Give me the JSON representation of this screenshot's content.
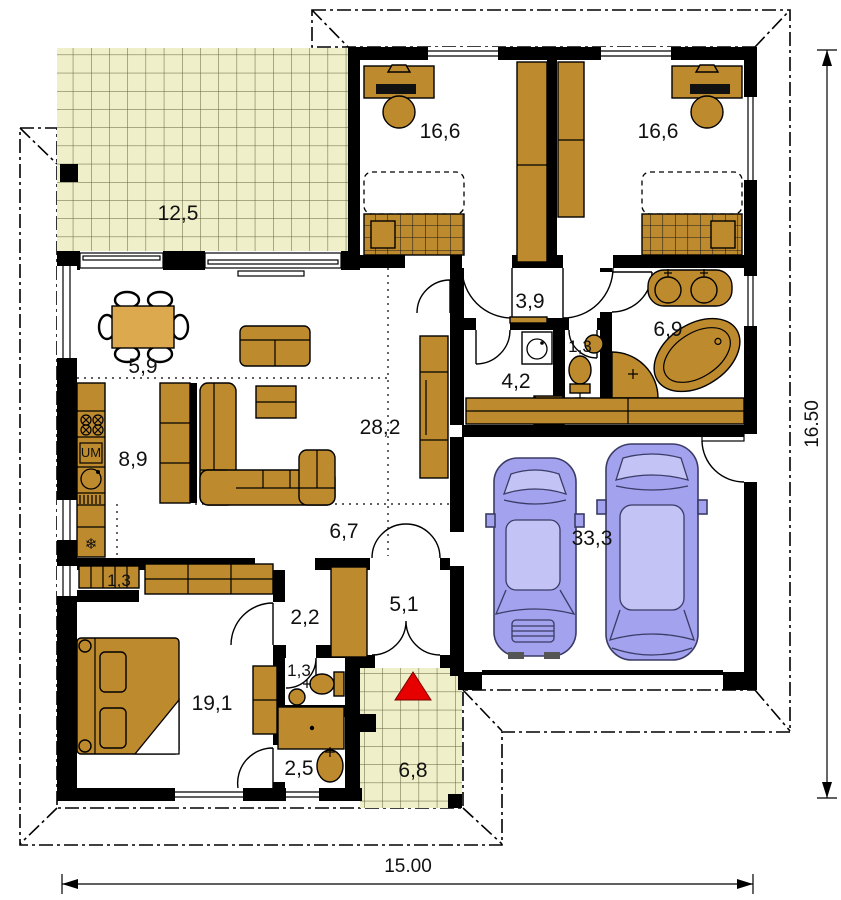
{
  "plan": {
    "type": "house-floor-plan",
    "rooms": [
      {
        "name": "terrace-top",
        "area": "12,5"
      },
      {
        "name": "bedroom-left",
        "area": "16,6"
      },
      {
        "name": "bedroom-right",
        "area": "16,6"
      },
      {
        "name": "hall-upper",
        "area": "3,9"
      },
      {
        "name": "wc-upper",
        "area": "1,3"
      },
      {
        "name": "bathroom-main",
        "area": "6,9"
      },
      {
        "name": "utility-room",
        "area": "4,2"
      },
      {
        "name": "dining-area",
        "area": "5,9"
      },
      {
        "name": "kitchen",
        "area": "8,9"
      },
      {
        "name": "living-room",
        "area": "28,2"
      },
      {
        "name": "hall-lower",
        "area": "6,7"
      },
      {
        "name": "garage",
        "area": "33,3"
      },
      {
        "name": "closet",
        "area": "1,3"
      },
      {
        "name": "hall-bedroom",
        "area": "2,2"
      },
      {
        "name": "entry-hall",
        "area": "5,1"
      },
      {
        "name": "wc-lower",
        "area": "1,3"
      },
      {
        "name": "bedroom-master",
        "area": "19,1"
      },
      {
        "name": "bathroom-small",
        "area": "2,5"
      },
      {
        "name": "terrace-entry",
        "area": "6,8"
      }
    ],
    "appliance_labels": {
      "dishwasher": "UM"
    },
    "icons": {
      "fridge_snowflake": "❄"
    },
    "dimensions": {
      "width": "15.00",
      "height": "16.50"
    },
    "colors": {
      "roof_overhang": "#F9908E",
      "terrace_tile": "#EFEFC9",
      "furniture": "#BE8A2E",
      "furniture_light": "#DDA94F",
      "car": "#A2A2EE",
      "wall": "#000000",
      "entrance_arrow": "#E60000"
    }
  }
}
